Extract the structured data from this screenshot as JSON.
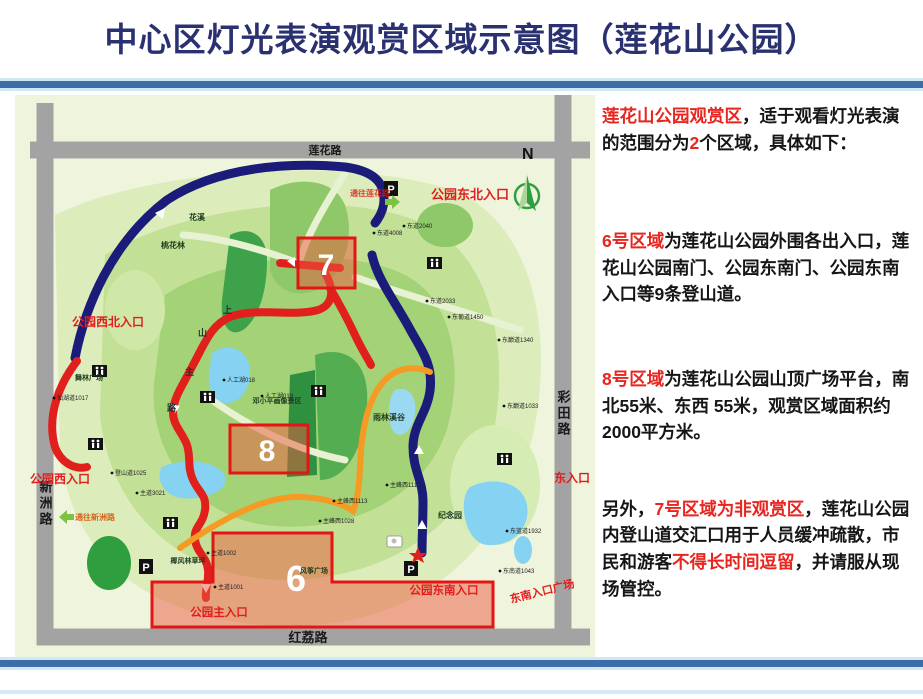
{
  "title": "中心区灯光表演观赏区域示意图（莲花山公园）",
  "colors": {
    "title_navy": "#2a3170",
    "bar_blue": "#3d6da8",
    "accent_red": "#e8251f",
    "region_border": "#e31515",
    "navy_path": "#1b1b7a",
    "red_path": "#e11f1c",
    "orange_path": "#f59a23",
    "road_gray": "#a3a3a3",
    "map_bg": "#eff4dd"
  },
  "panel": {
    "paragraphs": [
      {
        "segments": [
          {
            "t": "莲花山公园观赏区",
            "red": true
          },
          {
            "t": "，适于观看灯光表演的范围分为",
            "red": false
          },
          {
            "t": "2",
            "red": true
          },
          {
            "t": "个区域，具体如下：",
            "red": false
          }
        ]
      },
      {
        "segments": [
          {
            "t": "6号区域",
            "red": true
          },
          {
            "t": "为莲花山公园外围各出入口，莲花山公园南门、公园东南门、公园东南入口等9条登山道。",
            "red": false
          }
        ]
      },
      {
        "segments": [
          {
            "t": "8号区域",
            "red": true
          },
          {
            "t": "为莲花山公园山顶广场平台，南北55米、东西 55米，观赏区域面积约2000平方米。",
            "red": false
          }
        ]
      },
      {
        "segments": [
          {
            "t": "另外，",
            "red": false
          },
          {
            "t": "7号区域为非观赏区",
            "red": true
          },
          {
            "t": "，莲花山公园内登山道交汇口用于人员缓冲疏散，市民和游客",
            "red": false
          },
          {
            "t": "不得长时间逗留",
            "red": true
          },
          {
            "t": "，并请服从现场管控。",
            "red": false
          }
        ]
      }
    ]
  },
  "map": {
    "compass_label": "N",
    "roads": {
      "top": "莲花路",
      "bottom": "红荔路",
      "left": "新洲路",
      "right": "彩田路"
    },
    "regions": {
      "r7": {
        "number": "7"
      },
      "r8": {
        "number": "8"
      },
      "r6": {
        "number": "6"
      }
    },
    "entrances": {
      "northeast": "公园东北入口",
      "northwest": "公园西北入口",
      "west": "公园西入口",
      "east": "东入口",
      "main": "公园主入口",
      "southeast": "公园东南入口",
      "southeast_plaza": "东南入口广场"
    },
    "signs": {
      "to_lianhua": "通往莲花路",
      "to_xinzhou": "通往新洲路"
    },
    "places": {
      "huaxi": "花溪",
      "taohualin": "桃花林",
      "wulin_plaza": "舞林广场",
      "dengxiaoping": "邓小平画像景区",
      "yulin_valley": "雨林溪谷",
      "jinianyuan": "纪念园",
      "yefeng_lawn": "椰风林草坪",
      "fengzheng_plaza": "风筝广场"
    },
    "mountain_road_chars": [
      "上",
      "山",
      "主",
      "路"
    ],
    "parking_label": "P",
    "trail_markers": [
      {
        "x": 362,
        "y": 140,
        "label": "东道4008"
      },
      {
        "x": 392,
        "y": 133,
        "label": "东道2040"
      },
      {
        "x": 415,
        "y": 208,
        "label": "东道2033"
      },
      {
        "x": 437,
        "y": 224,
        "label": "东葡道1450"
      },
      {
        "x": 487,
        "y": 247,
        "label": "东巅道1340"
      },
      {
        "x": 492,
        "y": 313,
        "label": "东巅道1033"
      },
      {
        "x": 375,
        "y": 392,
        "label": "主峰西1112"
      },
      {
        "x": 322,
        "y": 408,
        "label": "主峰西1113"
      },
      {
        "x": 308,
        "y": 428,
        "label": "主峰西1028"
      },
      {
        "x": 212,
        "y": 287,
        "label": "人工湖018"
      },
      {
        "x": 250,
        "y": 303,
        "label": "人工湖019"
      },
      {
        "x": 100,
        "y": 380,
        "label": "登山道1025"
      },
      {
        "x": 42,
        "y": 305,
        "label": "仙湖道1017"
      },
      {
        "x": 125,
        "y": 400,
        "label": "主道3021"
      },
      {
        "x": 196,
        "y": 460,
        "label": "主道1002"
      },
      {
        "x": 203,
        "y": 494,
        "label": "主道1001"
      },
      {
        "x": 488,
        "y": 478,
        "label": "东南道1043"
      },
      {
        "x": 495,
        "y": 438,
        "label": "东蓝道1932"
      }
    ]
  }
}
